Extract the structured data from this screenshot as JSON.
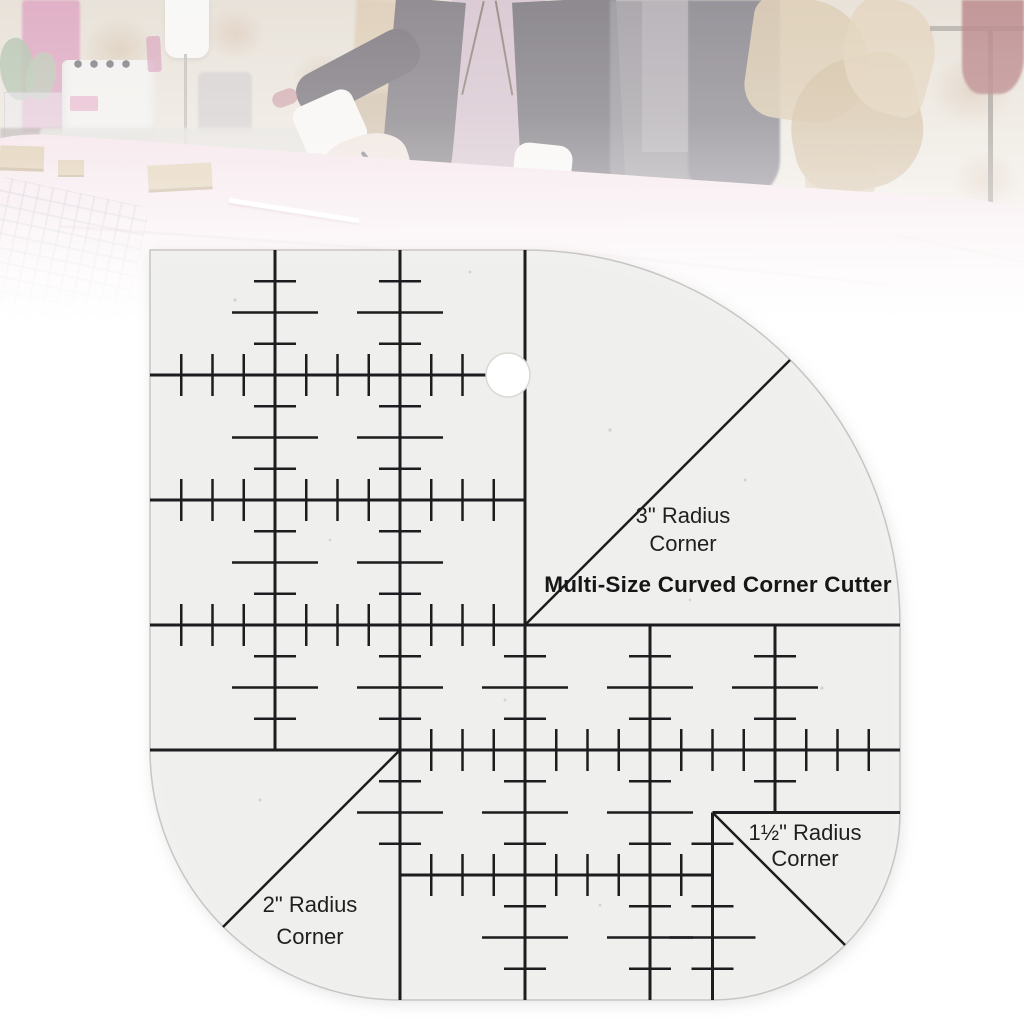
{
  "product": {
    "title": "Multi-Size Curved Corner Cutter",
    "corner_labels": {
      "r3": {
        "line1": "3\" Radius",
        "line2": "Corner"
      },
      "r2": {
        "line1": "2\" Radius",
        "line2": "Corner"
      },
      "r1_5": {
        "line1": "1½\" Radius",
        "line2": "Corner"
      }
    }
  },
  "colors": {
    "ruler_markings": "#1d1d1f",
    "ruler_body": "#f0efed",
    "background_fabric_pink": "#eed3dc",
    "kraft_paper_tan": "#c9b08a",
    "vest_dark": "#413b45",
    "pink_wall": "#c9699a"
  }
}
